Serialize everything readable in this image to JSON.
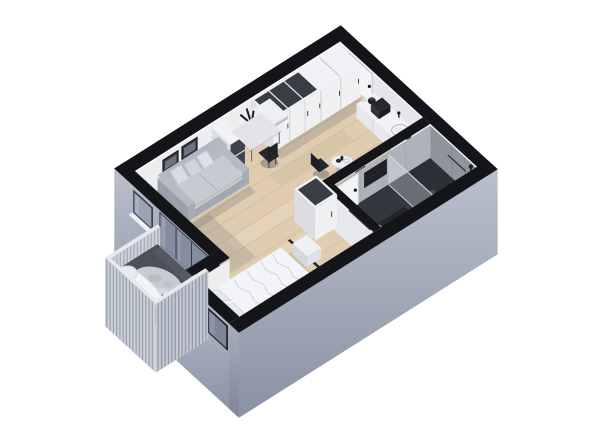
{
  "scene": {
    "title": "3D isometric floor plan render of a studio apartment",
    "background": "#ffffff",
    "rooms": [
      "living-area",
      "sleeping-nook",
      "kitchen",
      "bathroom",
      "hallway",
      "balcony"
    ],
    "objects": [
      {
        "id": "wall-top-left",
        "label": "back wall with picture frames"
      },
      {
        "id": "wall-top-right",
        "label": "back wall with entrance door and bathroom tile"
      },
      {
        "id": "floor",
        "label": "wood plank floor and bathroom floor"
      },
      {
        "id": "wall-frames",
        "label": "two framed pictures above sofa"
      },
      {
        "id": "wardrobe-row",
        "label": "wardrobe cabinets with open shelving"
      },
      {
        "id": "kitchen-counter",
        "label": "kitchen counter with sink and appliances"
      },
      {
        "id": "desk-area",
        "label": "floating shelf, plant, desk and chair"
      },
      {
        "id": "sofa",
        "label": "gray sofa with pillows"
      },
      {
        "id": "dining-set",
        "label": "small dining table with two chairs"
      },
      {
        "id": "bathroom-north-wall",
        "label": "bathroom partition wall with door"
      },
      {
        "id": "bathroom-interior",
        "label": "shower glass, tray and toilet"
      },
      {
        "id": "bathroom-west-wall",
        "label": "bathroom partition wall"
      },
      {
        "id": "hall-wardrobe",
        "label": "freestanding wardrobe"
      },
      {
        "id": "exterior-wall-left",
        "label": "exterior wall with window and balcony glass door"
      },
      {
        "id": "bump-wall-north",
        "label": "sleeping nook wall"
      },
      {
        "id": "bed",
        "label": "double bed with white duvet and pillows"
      },
      {
        "id": "bump-wall-west",
        "label": "exterior nook wall with window"
      },
      {
        "id": "exterior-wall-right",
        "label": "large exterior wall"
      },
      {
        "id": "balcony",
        "label": "balcony with railing, lounger, rug and planter"
      }
    ]
  },
  "palette": {
    "capBlack": "#141519",
    "wallInterior": "#ebedef",
    "wallInteriorShade": "#e4e6e9",
    "wallSide": "#dcdee2",
    "extWallLight": "#bac0cc",
    "extWallDark": "#8a92a3",
    "extWallSide": "#8d94a3",
    "floorWood": "#dfccb1",
    "floorWoodLight": "#ead9c0",
    "floorWoodDark": "#d2bc9e",
    "floorSeam": "#c8b296",
    "bathFloor": "#34373d",
    "bathWall": "#aeb2ba",
    "bathWallDark": "#8f949d",
    "trayDark": "#2c2f35",
    "glassPane": "#8b95a7",
    "glassFrame": "#33373f",
    "windowGlass": "#9aa4b4",
    "windowFrame": "#3c4047",
    "bumpWindowFrame": "#17191d",
    "bumpWindowGlass": "#7b8698",
    "furnWhite": "#eef0f2",
    "furnWhiteTop": "#f1f2f5",
    "furnSeam": "#b9bcc2",
    "openShelfDark": "#3a3d43",
    "handleDark": "#2c2e33",
    "counterFront": "#e7e9ed",
    "counterSide": "#d9dce1",
    "sofaBase": "#a2a8b3",
    "sofaBody": "#b5bac4",
    "sofaBack": "#b2b7c1",
    "sofaCushion": "#c6cbd3",
    "pillowLight": "#d9dde3",
    "black": "#1d1f24",
    "chairBlack": "#24262b",
    "deskTop": "#e2e4e8",
    "duvet": "#f3f4f7",
    "duvetShade": "#e7e9ee",
    "duvetLine": "#d5d8df",
    "pillowBed": "#e6e9ee",
    "bedBaseFront": "#b6bac2",
    "bedBaseSide": "#a9aeb7",
    "benchWhite": "#eff0f3",
    "railingCap": "#e7e9ed",
    "railingFace": "#ccd1d9",
    "railingStripe": "#939baa",
    "balconyFloor": "#4c5058",
    "rug": "#c7cbd2",
    "loungerWhite": "#f3f4f6",
    "plantGreen": "#7d9070",
    "shadow": "rgba(52,57,70,0.16)",
    "shadowStrong": "rgba(42,46,58,0.30)"
  }
}
